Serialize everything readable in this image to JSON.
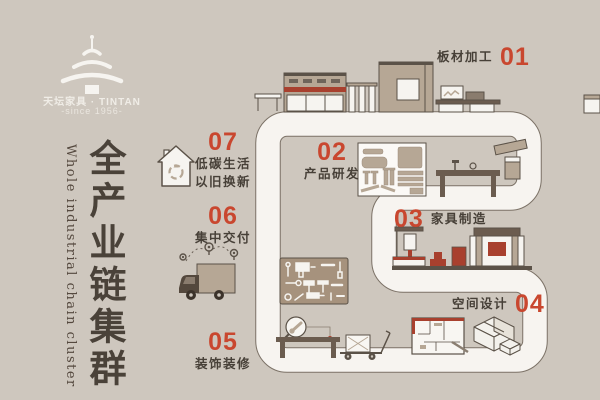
{
  "brand": {
    "logo_icon": "temple-of-heaven-logo-icon",
    "name": "天坛家具 · TINTAN",
    "since": "-since 1956-"
  },
  "title": {
    "zh": "全产业链集群",
    "en": "Whole industrial chain cluster"
  },
  "steps": [
    {
      "num": "01",
      "label": "板材加工"
    },
    {
      "num": "02",
      "label": "产品研发"
    },
    {
      "num": "03",
      "label": "家具制造"
    },
    {
      "num": "04",
      "label": "空间设计"
    },
    {
      "num": "05",
      "label": "装饰装修"
    },
    {
      "num": "06",
      "label": "集中交付"
    },
    {
      "num": "07",
      "label": "低碳生活",
      "label2": "以旧换新"
    }
  ],
  "icons": [
    "temple-of-heaven-logo-icon",
    "recycle-house-icon",
    "delivery-truck-icon",
    "location-pin-icon",
    "magnifier-wrench-icon",
    "tools-panel-icon",
    "floor-plan-icon",
    "isometric-room-icon",
    "hand-trolley-icon"
  ],
  "colors": {
    "background": "#cec7be",
    "path_white": "#f7f4f0",
    "accent": "#c9472f",
    "ink": "#474038",
    "tan": "#b6a795",
    "dark_red": "#a8402e",
    "brown": "#6b5c4f"
  }
}
